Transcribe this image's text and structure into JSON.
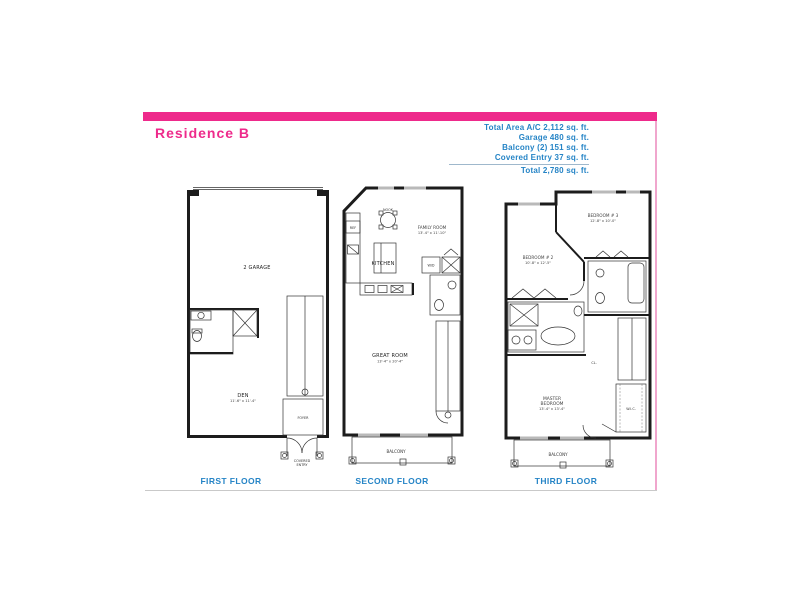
{
  "header": {
    "title": "Residence B"
  },
  "summary": {
    "line1": "Total Area A/C 2,112 sq. ft.",
    "line2": "Garage 480 sq. ft.",
    "line3": "Balcony (2) 151 sq. ft.",
    "line4": "Covered Entry 37 sq. ft.",
    "line5": "Total 2,780 sq. ft."
  },
  "colors": {
    "accent_pink": "#ee2a8b",
    "text_blue": "#2584c6",
    "plan_ink": "#1c1c1c",
    "divider_gray": "#c9c9c9"
  },
  "floors": {
    "first": {
      "caption": "FIRST FLOOR",
      "rooms": {
        "garage": "2 GARAGE",
        "den_name": "DEN",
        "den_dims": "11'-6\" x 11'-4\"",
        "foyer": "FOYER",
        "covered_entry_1": "COVERED",
        "covered_entry_2": "ENTRY"
      }
    },
    "second": {
      "caption": "SECOND FLOOR",
      "rooms": {
        "nook": "NOOK",
        "family_name": "FAMILY ROOM",
        "family_dims": "13'-4\" x 11'-10\"",
        "kitchen": "KITCHEN",
        "ref": "REF",
        "wd": "W/D",
        "great_name": "GREAT ROOM",
        "great_dims": "13'-4\" x 20'-4\"",
        "balcony": "BALCONY"
      }
    },
    "third": {
      "caption": "THIRD FLOOR",
      "rooms": {
        "bedroom3_name": "BEDROOM # 3",
        "bedroom3_dims": "12'-8\" x 10'-0\"",
        "bedroom2_name": "BEDROOM # 2",
        "bedroom2_dims": "10'-8\" x 12'-5\"",
        "master_1": "MASTER",
        "master_2": "BEDROOM",
        "master_dims": "13'-4\" x 13'-4\"",
        "cl": "CL.",
        "wic": "W.I.C.",
        "balcony": "BALCONY"
      }
    }
  }
}
